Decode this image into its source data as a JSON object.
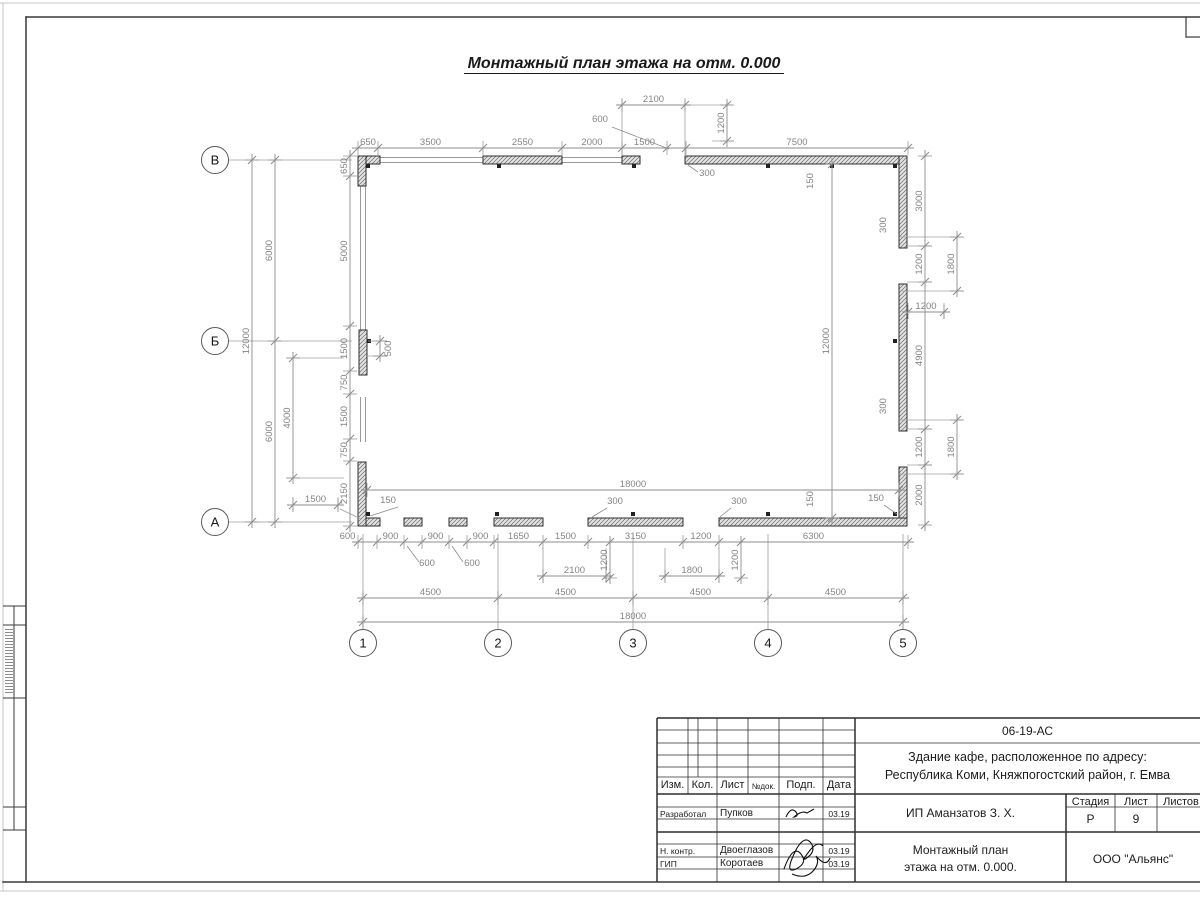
{
  "sheet": {
    "title": "Монтажный план этажа на отм. 0.000",
    "title_block": {
      "doc_code": "06-19-АС",
      "object_line1": "Здание кафе, расположенное по адресу:",
      "object_line2": "Республика Коми, Княжпогостский район, г. Емва",
      "client": "ИП Аманзатов З. Х.",
      "drawing_name_line1": "Монтажный план",
      "drawing_name_line2": "этажа на отм. 0.000.",
      "company": "ООО \"Альянс\"",
      "stage_label": "Стадия",
      "sheet_label": "Лист",
      "sheets_label": "Листов",
      "stage_value": "Р",
      "sheet_value": "9",
      "cols": {
        "izm": "Изм.",
        "kol": "Кол.",
        "list": "Лист",
        "ndok": "№док.",
        "podp": "Подп.",
        "data": "Дата"
      },
      "rows": [
        {
          "role": "Разработал",
          "name": "Пупков",
          "date": "03.19"
        },
        {
          "role": "Н. контр.",
          "name": "Двоеглазов",
          "date": "03.19"
        },
        {
          "role": "ГИП",
          "name": "Коротаев",
          "date": "03.19"
        }
      ]
    }
  },
  "plan": {
    "axes_cols": [
      {
        "label": "1",
        "x": 363
      },
      {
        "label": "2",
        "x": 498
      },
      {
        "label": "3",
        "x": 633
      },
      {
        "label": "4",
        "x": 768
      },
      {
        "label": "5",
        "x": 903
      }
    ],
    "axes_rows": [
      {
        "label": "В",
        "y": 160
      },
      {
        "label": "Б",
        "y": 341
      },
      {
        "label": "А",
        "y": 522
      }
    ],
    "dims": [
      {
        "dir": "h",
        "at": 148,
        "pts": [
          358,
          378,
          483,
          562,
          622,
          667,
          686,
          908
        ],
        "labels": [
          "650",
          "3500",
          "2550",
          "2000",
          "1500",
          null,
          "7500"
        ]
      },
      {
        "dir": "h",
        "at": 105,
        "pts": [
          622,
          685
        ],
        "labels": [
          "2100"
        ]
      },
      {
        "dir": "v",
        "at": 727,
        "pts": [
          105,
          141
        ],
        "labels": [
          "1200"
        ]
      },
      {
        "dir": "v",
        "at": 925,
        "pts": [
          156,
          246,
          282,
          429,
          465,
          525
        ],
        "labels": [
          "3000",
          "1200",
          "4900",
          "1200",
          "2000"
        ]
      },
      {
        "dir": "v",
        "at": 957,
        "pts": [
          237,
          291
        ],
        "labels": [
          "1800"
        ]
      },
      {
        "dir": "v",
        "at": 957,
        "pts": [
          420,
          474
        ],
        "labels": [
          "1800"
        ]
      },
      {
        "dir": "h",
        "at": 312,
        "pts": [
          908,
          944
        ],
        "labels": [
          "1200"
        ]
      },
      {
        "dir": "v",
        "at": 832,
        "pts": [
          164,
          518
        ],
        "labels": [
          "12000"
        ]
      },
      {
        "dir": "h",
        "at": 490,
        "pts": [
          367,
          899
        ],
        "labels": [
          "18000"
        ]
      },
      {
        "dir": "h",
        "at": 542,
        "pts": [
          358,
          377,
          404,
          422,
          449,
          467,
          494,
          543,
          588,
          683,
          719,
          908
        ],
        "labels": [
          {
            "t": "600",
            "dx": -20
          },
          "900",
          null,
          "900",
          null,
          "900",
          "1650",
          "1500",
          "3150",
          "1200",
          "6300"
        ]
      },
      {
        "dir": "h",
        "at": 576,
        "pts": [
          543,
          606
        ],
        "labels": [
          "2100"
        ]
      },
      {
        "dir": "v",
        "at": 610,
        "pts": [
          542,
          578
        ],
        "labels": [
          "1200"
        ]
      },
      {
        "dir": "h",
        "at": 576,
        "pts": [
          665,
          719
        ],
        "labels": [
          "1800"
        ]
      },
      {
        "dir": "v",
        "at": 741,
        "pts": [
          542,
          578
        ],
        "labels": [
          "1200"
        ]
      },
      {
        "dir": "h",
        "at": 598,
        "pts": [
          363,
          498,
          633,
          768,
          903
        ],
        "labels": [
          "4500",
          "4500",
          "4500",
          "4500"
        ]
      },
      {
        "dir": "h",
        "at": 622,
        "pts": [
          363,
          903
        ],
        "labels": [
          "18000"
        ]
      },
      {
        "dir": "v",
        "at": 252,
        "pts": [
          160,
          522
        ],
        "labels": [
          "12000"
        ]
      },
      {
        "dir": "v",
        "at": 275,
        "pts": [
          160,
          341,
          522
        ],
        "labels": [
          "6000",
          "6000"
        ]
      },
      {
        "dir": "v",
        "at": 350,
        "pts": [
          156,
          176,
          326,
          371,
          394,
          439,
          461,
          526
        ],
        "labels": [
          "650",
          "5000",
          "1500",
          "750",
          "1500",
          "750",
          "2150"
        ]
      },
      {
        "dir": "v",
        "at": 293,
        "pts": [
          358,
          478
        ],
        "labels": [
          "4000"
        ]
      },
      {
        "dir": "h",
        "at": 505,
        "pts": [
          293,
          338
        ],
        "labels": [
          "1500"
        ]
      },
      {
        "dir": "v",
        "at": 380,
        "pts": [
          341,
          356
        ],
        "labels": [
          {
            "t": "500",
            "dx": 14
          }
        ]
      }
    ],
    "leaders": [
      {
        "t": "600",
        "x": 600,
        "y": 122,
        "line": [
          612,
          127,
          669,
          149
        ]
      },
      {
        "t": "300",
        "x": 707,
        "y": 176,
        "line": [
          698,
          172,
          688,
          165
        ]
      },
      {
        "t": "150",
        "x": 813,
        "y": 181,
        "rot": -90
      },
      {
        "t": "150",
        "x": 813,
        "y": 499,
        "rot": -90
      },
      {
        "t": "300",
        "x": 886,
        "y": 225,
        "rot": -90
      },
      {
        "t": "300",
        "x": 886,
        "y": 406,
        "rot": -90
      },
      {
        "t": "150",
        "x": 388,
        "y": 503,
        "line": [
          398,
          507,
          370,
          516
        ]
      },
      {
        "t": "300",
        "x": 615,
        "y": 504,
        "line": [
          607,
          508,
          592,
          517
        ]
      },
      {
        "t": "300",
        "x": 739,
        "y": 504,
        "line": [
          731,
          508,
          720,
          517
        ]
      },
      {
        "t": "150",
        "x": 876,
        "y": 501,
        "line": [
          884,
          505,
          897,
          514
        ]
      },
      {
        "t": "600",
        "x": 427,
        "y": 566,
        "line": [
          419,
          562,
          407,
          546
        ]
      },
      {
        "t": "600",
        "x": 472,
        "y": 566,
        "line": [
          463,
          562,
          452,
          546
        ]
      }
    ]
  }
}
